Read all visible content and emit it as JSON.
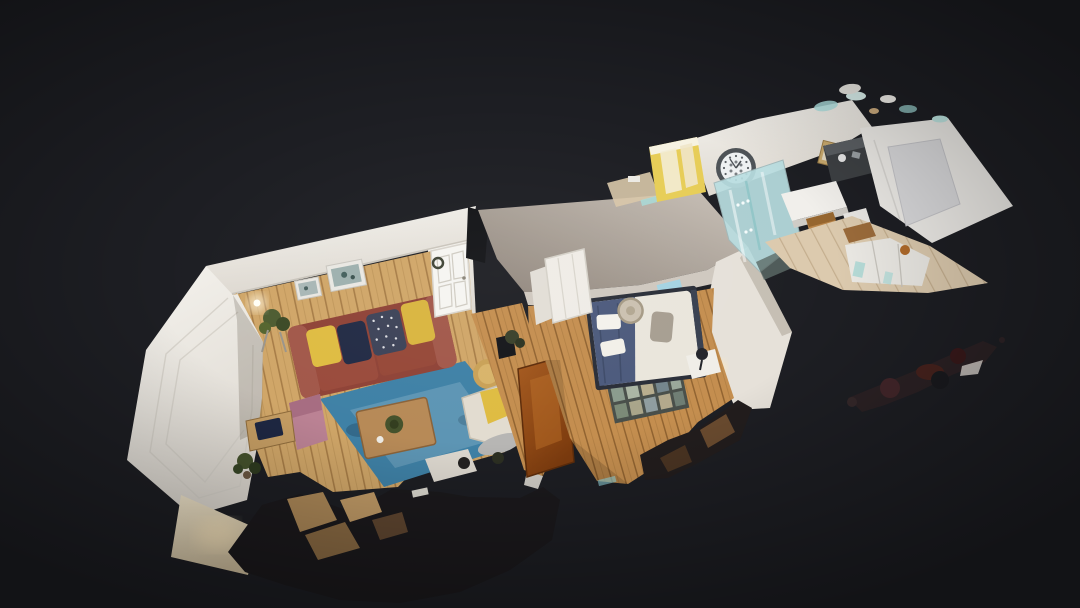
{
  "view": {
    "mode": "dollhouse",
    "description": "Overhead 3D dollhouse scan of a one-bedroom flat floating on a dark background"
  },
  "rooms": [
    {
      "id": "living-room",
      "label": "Living room",
      "contents": [
        "bay window",
        "red leather sofa",
        "yellow and navy cushions",
        "blue rug",
        "wooden coffee table",
        "cream armchair",
        "pink chair",
        "desk with laptop",
        "potted plants",
        "framed botanical prints",
        "white panelled door",
        "sideboard"
      ]
    },
    {
      "id": "hallway",
      "label": "Hallway",
      "contents": [
        "open stained wooden door",
        "small plant"
      ]
    },
    {
      "id": "bedroom",
      "label": "Bedroom",
      "contents": [
        "double bed with navy throw",
        "white pillows",
        "woven hat on bed",
        "tiled hearth",
        "open wardrobe doors",
        "bedside table with lamp",
        "window"
      ]
    },
    {
      "id": "kitchen-bathroom",
      "label": "Kitchen and bathroom",
      "contents": [
        "wall clock",
        "yellow cabinet",
        "glass shower screen",
        "kitchen table",
        "wooden chair",
        "dark appliances",
        "fridge panels",
        "cabinet fronts",
        "small picture frame"
      ]
    }
  ],
  "artifacts": [
    "floating scan debris on the right",
    "ragged scan cut along bottom edge",
    "cyan fringe artifacts on wall tops",
    "warm lamp glows"
  ],
  "colors": {
    "background": "#1d1e23",
    "wall_white": "#f0ede7",
    "wall_shadow": "#d8d3cb",
    "wall_taupe": "#b0a59b",
    "wall_taupe_lit": "#cfc8bf",
    "wall_cream_glow": "#ecdfc2",
    "floor_living": "#d0a668",
    "floor_bedroom": "#c48e4f",
    "floor_kitchen": "#dccaae",
    "rug": "#3f81a6",
    "sofa": "#8f4337",
    "sofa_arm": "#a2584a",
    "cushion_yellow": "#dfbc42",
    "cushion_navy": "#222b45",
    "cushion_pattern": "#3d4358",
    "table_wood": "#b78a57",
    "stool": "#c9a157",
    "armchair": "#e2dcd0",
    "chair_pink": "#bb8294",
    "desk_wood": "#c59d63",
    "laptop_navy": "#1e2742",
    "plant_green": "#45522c",
    "bed_frame": "#2a2e38",
    "bed_duvet": "#eae6dc",
    "bed_throw": "#4c5a7c",
    "pillow_white": "#f4f2ec",
    "cushion_gray": "#a79e91",
    "hat_straw": "#cbc1b0",
    "door_orange": "#9c5117",
    "wardrobe_white": "#efece6",
    "glass_aqua": "#b9dee1",
    "cabinet_yellow": "#e7cd57",
    "clock_ring": "#4e5357",
    "clock_face": "#eef1f2",
    "appliance_dark": "#3d4043",
    "fridge_panel": "#d9d9db",
    "kitchen_table_white": "#f1efeb",
    "chair_wood": "#b9854a",
    "debris_dark": "#1b191c",
    "debris_maroon": "#47221d",
    "glow_warm": "#ffe9bd",
    "fringe_cyan": "#a8dcda",
    "window_cyan": "#9fd4e6"
  }
}
